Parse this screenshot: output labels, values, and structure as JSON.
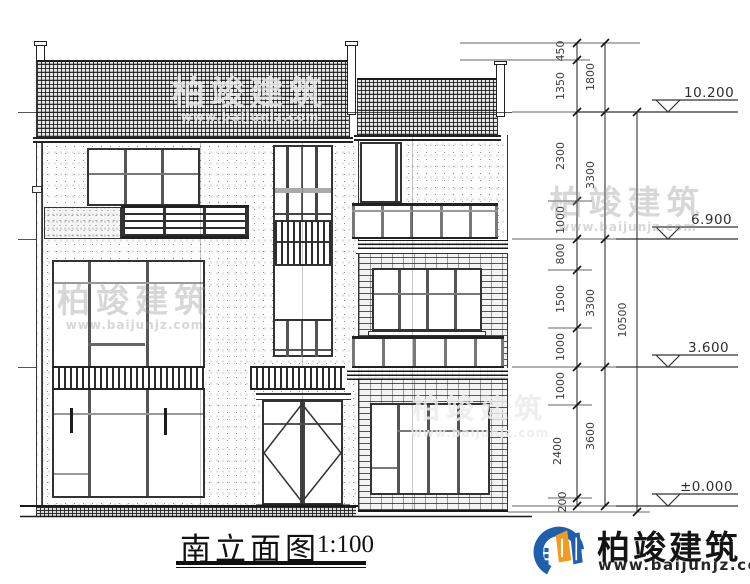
{
  "drawing": {
    "title": "南立面图",
    "scale": "1:100"
  },
  "levels": {
    "roof": "10.200",
    "third_floor": "6.900",
    "second_floor": "3.600",
    "ground": "±0.000"
  },
  "dims": {
    "chain_inner": [
      "450",
      "1350",
      "2300",
      "1000",
      "800",
      "1500",
      "1000",
      "1000",
      "2400",
      "200"
    ],
    "chain_floor": [
      "1800",
      "3300",
      "3300",
      "3600"
    ],
    "total": "10500",
    "stair": [
      "1900",
      "600",
      "600",
      "2400",
      "300"
    ],
    "door": [
      "2700",
      "300"
    ]
  },
  "watermark": {
    "brand": "柏竣建筑",
    "url": "www.baijunjz.com"
  },
  "footer": {
    "brand": "柏竣建筑",
    "url": "www.baijunjz.com"
  }
}
